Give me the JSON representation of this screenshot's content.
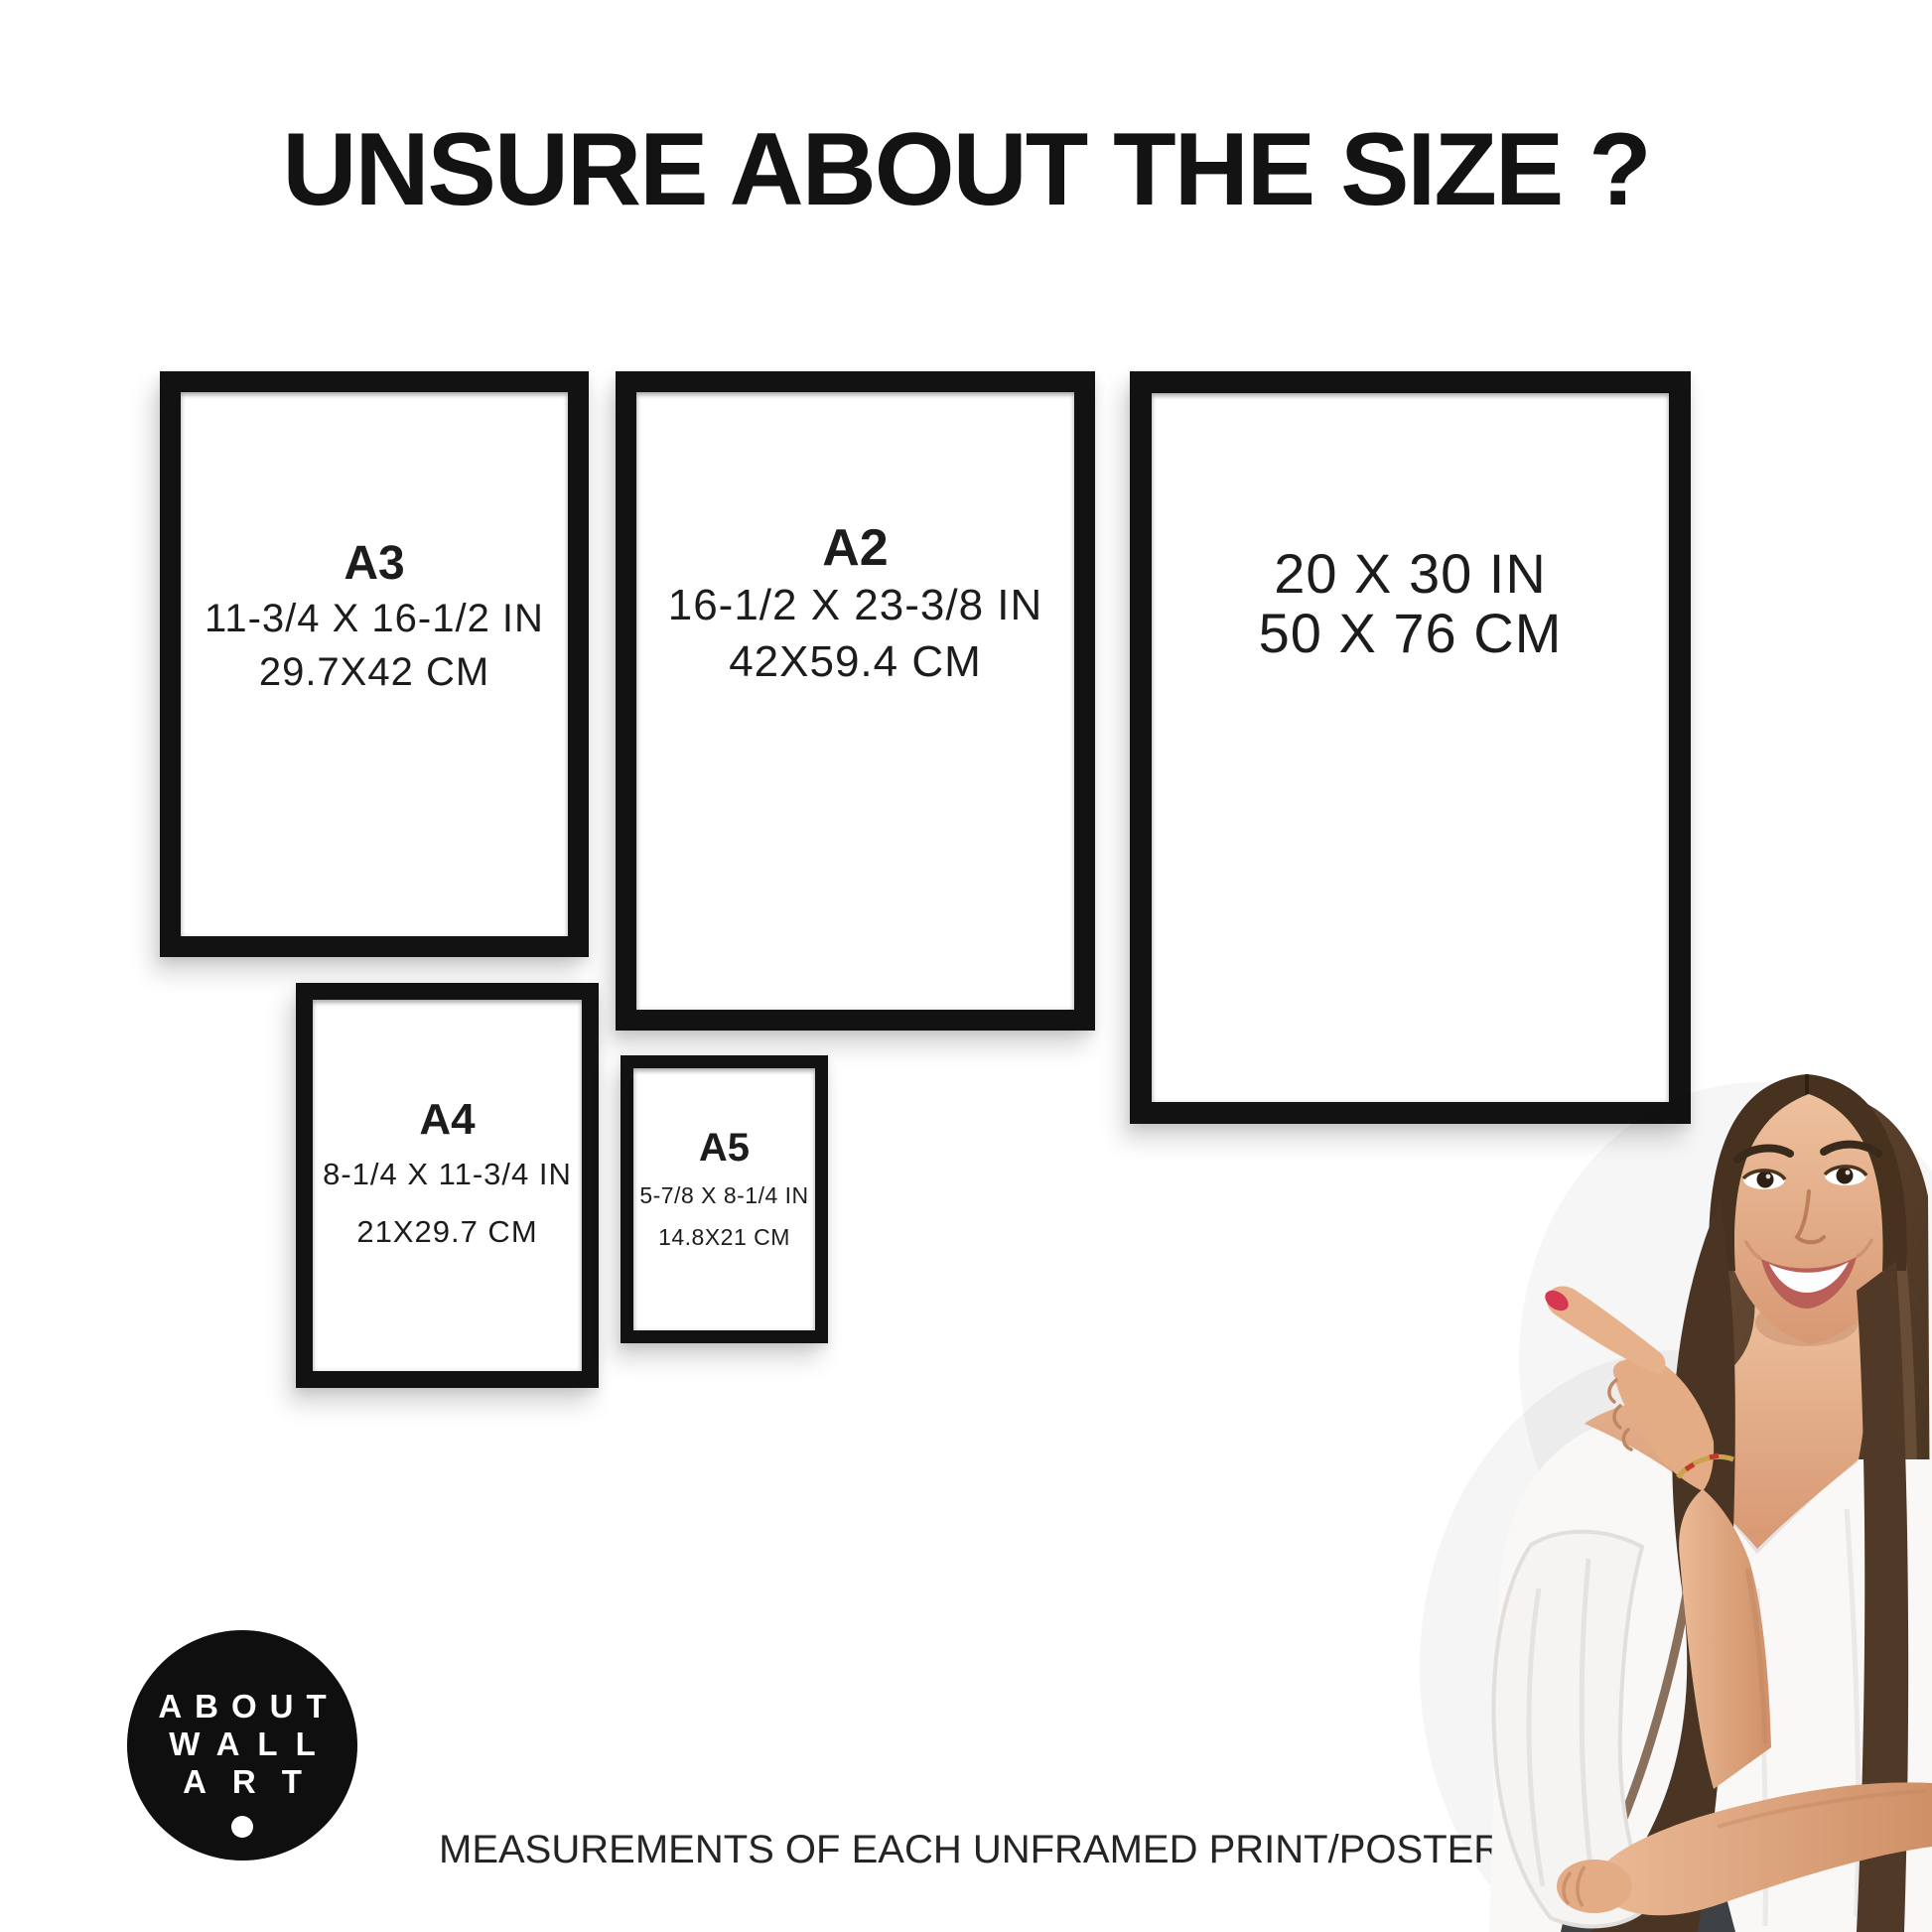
{
  "page": {
    "title": "UNSURE ABOUT THE SIZE ?",
    "footer": "MEASUREMENTS OF EACH UNFRAMED PRINT/POSTER"
  },
  "frames": {
    "a3": {
      "label": "A3",
      "size_in": "11-3/4 X 16-1/2 IN",
      "size_cm": "29.7X42 CM"
    },
    "a2": {
      "label": "A2",
      "size_in": "16-1/2 X 23-3/8 IN",
      "size_cm": "42X59.4 CM"
    },
    "poster20x30": {
      "size_in": "20 X 30 IN",
      "size_cm": "50 X 76 CM"
    },
    "a4": {
      "label": "A4",
      "size_in": "8-1/4 X 11-3/4 IN",
      "size_cm": "21X29.7 CM"
    },
    "a5": {
      "label": "A5",
      "size_in": "5-7/8 X 8-1/4 IN",
      "size_cm": "14.8X21 CM"
    }
  },
  "logo": {
    "line1": "ABOUT",
    "line2": "WALL",
    "line3": "ART"
  },
  "colors": {
    "frame_black": "#121212",
    "text_black": "#1c1c1c",
    "logo_bg": "#0f0f0f",
    "logo_text": "#ffffff",
    "nail_red": "#d63852",
    "hair_brown": "#5b4330",
    "skin_tone": "#e4ab88",
    "blouse_white": "#f9f8f7",
    "jeans_dark": "#3e4245"
  }
}
